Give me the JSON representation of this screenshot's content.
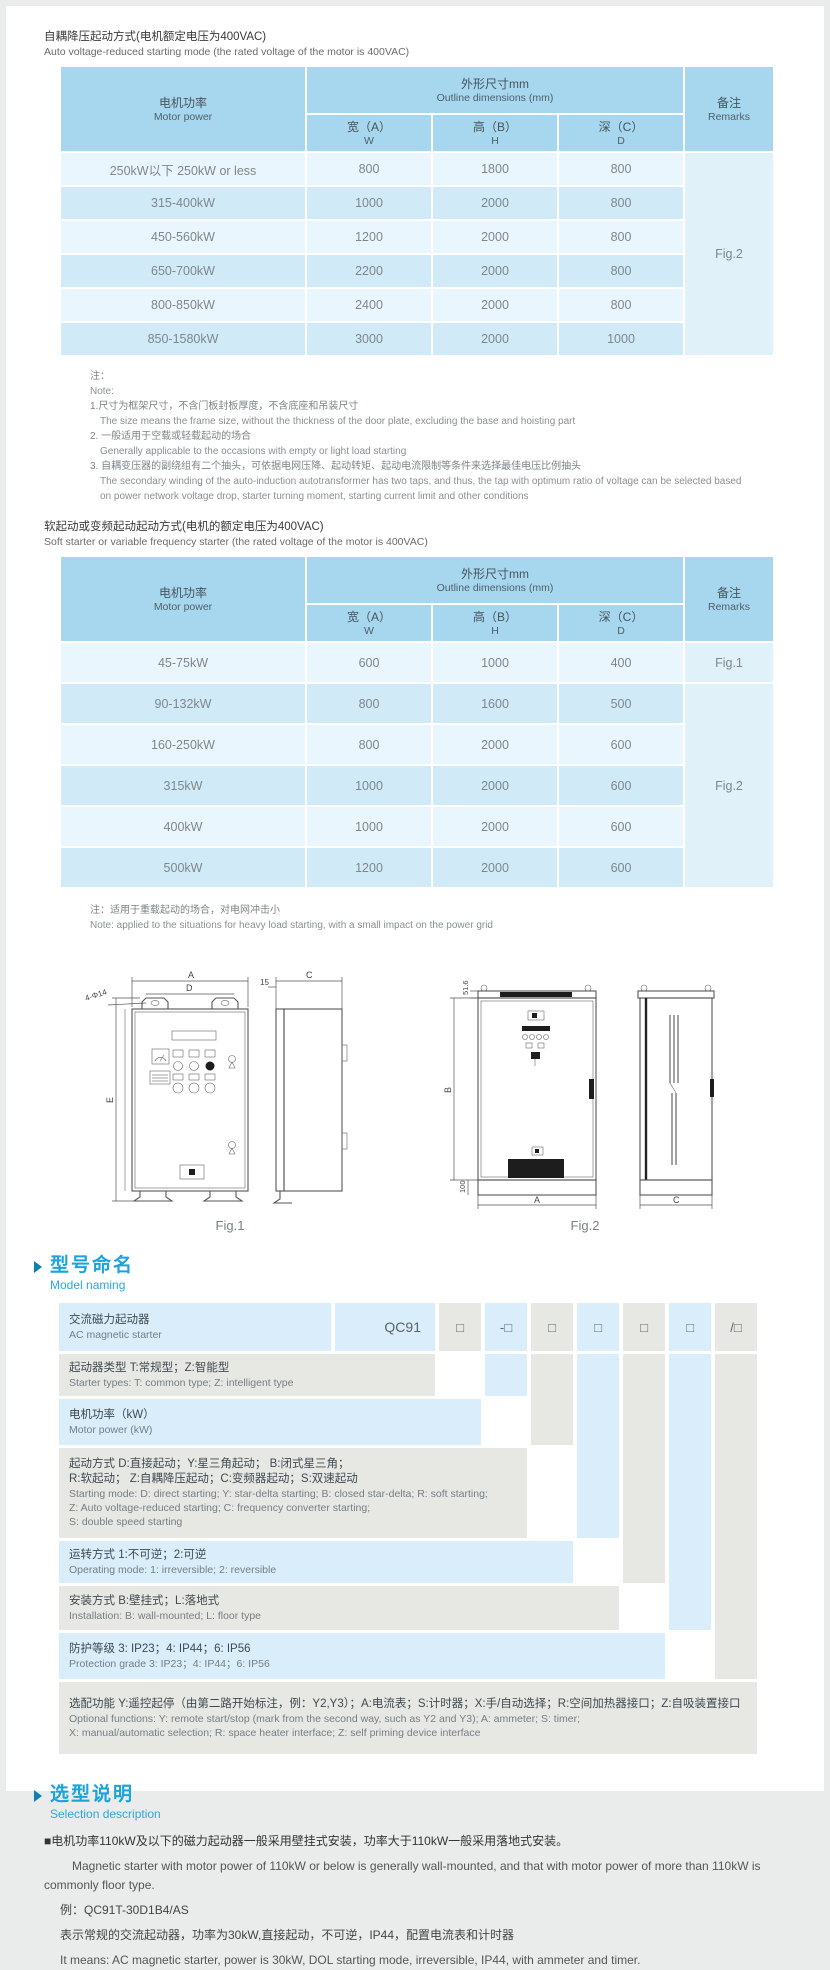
{
  "table1": {
    "title_zh": "自耦降压起动方式(电机额定电压为400VAC)",
    "title_en": "Auto voltage-reduced starting mode (the rated voltage of the motor is 400VAC)",
    "col_motor_zh": "电机功率",
    "col_motor_en": "Motor power",
    "col_dims_zh": "外形尺寸mm",
    "col_dims_en": "Outline dimensions (mm)",
    "col_w_zh": "宽（A）",
    "col_w_en": "W",
    "col_h_zh": "高（B）",
    "col_h_en": "H",
    "col_d_zh": "深（C）",
    "col_d_en": "D",
    "col_rem_zh": "备注",
    "col_rem_en": "Remarks",
    "remark": "Fig.2",
    "rows": [
      {
        "power": "250kW以下 250kW or less",
        "w": "800",
        "h": "1800",
        "d": "800"
      },
      {
        "power": "315-400kW",
        "w": "1000",
        "h": "2000",
        "d": "800"
      },
      {
        "power": "450-560kW",
        "w": "1200",
        "h": "2000",
        "d": "800"
      },
      {
        "power": "650-700kW",
        "w": "2200",
        "h": "2000",
        "d": "800"
      },
      {
        "power": "800-850kW",
        "w": "2400",
        "h": "2000",
        "d": "800"
      },
      {
        "power": "850-1580kW",
        "w": "3000",
        "h": "2000",
        "d": "1000"
      }
    ]
  },
  "notes1": {
    "zh_label": "注：",
    "en_label": "Note:",
    "items": [
      {
        "zh": "1.尺寸为框架尺寸，不含门板封板厚度，不含底座和吊装尺寸",
        "en": "The size means the frame size, without the thickness of the door plate, excluding the base and hoisting part"
      },
      {
        "zh": "2. 一般适用于空载或轻载起动的场合",
        "en": "Generally applicable to the occasions with empty or light load starting"
      },
      {
        "zh": "3. 自耦变压器的副绕组有二个抽头，可依据电网压降、起动转矩、起动电流限制等条件来选择最佳电压比例抽头",
        "en": "The secondary winding of the auto-induction autotransformer has two taps, and thus, the tap with optimum ratio of voltage can be selected based on power network voltage drop, starter turning moment, starting current limit and other conditions"
      }
    ]
  },
  "table2": {
    "title_zh": "软起动或变频起动起动方式(电机的额定电压为400VAC)",
    "title_en": "Soft starter or variable frequency starter (the rated voltage of the motor is 400VAC)",
    "col_motor_zh": "电机功率",
    "col_motor_en": "Motor power",
    "col_dims_zh": "外形尺寸mm",
    "col_dims_en": "Outline dimensions (mm)",
    "col_w_zh": "宽（A）",
    "col_w_en": "W",
    "col_h_zh": "高（B）",
    "col_h_en": "H",
    "col_d_zh": "深（C）",
    "col_d_en": "D",
    "col_rem_zh": "备注",
    "col_rem_en": "Remarks",
    "remark_row1": "Fig.1",
    "remark_rest": "Fig.2",
    "rows": [
      {
        "power": "45-75kW",
        "w": "600",
        "h": "1000",
        "d": "400"
      },
      {
        "power": "90-132kW",
        "w": "800",
        "h": "1600",
        "d": "500"
      },
      {
        "power": "160-250kW",
        "w": "800",
        "h": "2000",
        "d": "600"
      },
      {
        "power": "315kW",
        "w": "1000",
        "h": "2000",
        "d": "600"
      },
      {
        "power": "400kW",
        "w": "1000",
        "h": "2000",
        "d": "600"
      },
      {
        "power": "500kW",
        "w": "1200",
        "h": "2000",
        "d": "600"
      }
    ],
    "note_zh": "注：适用于重载起动的场合，对电网冲击小",
    "note_en": "Note: applied to the situations for heavy load starting, with a small impact on the power grid"
  },
  "figures": {
    "fig1": {
      "caption": "Fig.1",
      "dim_a": "A",
      "dim_d": "D",
      "dim_hole": "4-Φ14",
      "dim_e": "E",
      "dim_15": "15",
      "dim_c": "C"
    },
    "fig2": {
      "caption": "Fig.2",
      "dim_516": "51.6",
      "dim_b": "B",
      "dim_100": "100",
      "dim_a": "A",
      "dim_c": "C"
    }
  },
  "model_naming": {
    "heading_zh": "型号命名",
    "heading_en": "Model naming",
    "row1_zh": "交流磁力起动器",
    "row1_en": "AC magnetic starter",
    "code_prefix": "QC91",
    "boxes": [
      "□",
      "-□",
      "□",
      "□",
      "□",
      "□",
      "/□"
    ],
    "rows": [
      {
        "zh": "起动器类型 T:常规型；Z:智能型",
        "en": "Starter types: T: common type; Z: intelligent type"
      },
      {
        "zh": "电机功率（kW）",
        "en": "Motor power (kW)"
      },
      {
        "zh": "起动方式 D:直接起动；Y:星三角起动；  B:闭式星三角；\n                R:软起动；  Z:自耦降压起动；C:变频器起动；S:双速起动",
        "en": "Starting mode: D: direct starting; Y: star-delta starting; B: closed star-delta; R: soft starting;\n            Z: Auto voltage-reduced starting; C: frequency converter starting;\n            S: double speed starting"
      },
      {
        "zh": "运转方式 1:不可逆；2:可逆",
        "en": "Operating mode: 1: irreversible; 2: reversible"
      },
      {
        "zh": "安装方式 B:壁挂式；L:落地式",
        "en": "Installation: B: wall-mounted; L: floor type"
      },
      {
        "zh": "防护等级 3: IP23；4: IP44；6: IP56",
        "en": "Protection grade 3: IP23；4: IP44；6: IP56"
      },
      {
        "zh": "选配功能 Y:遥控起停（由第二路开始标注，例：Y2,Y3）；A:电流表；S:计时器；X:手/自动选择；R:空间加热器接口；Z:自吸装置接口",
        "en": "Optional functions: Y: remote start/stop (mark from the second way, such as Y2 and Y3); A: ammeter; S: timer;\n            X: manual/automatic selection; R: space heater interface; Z: self priming device interface"
      }
    ]
  },
  "selection": {
    "heading_zh": "选型说明",
    "heading_en": "Selection description",
    "p1_zh": "■电机功率110kW及以下的磁力起动器一般采用壁挂式安装，功率大于110kW一般采用落地式安装。",
    "p1_en": "Magnetic starter with motor power of 110kW or below is generally wall-mounted, and that with motor power of more than 110kW is commonly floor type.",
    "example": "例：QC91T-30D1B4/AS",
    "p2_zh": "表示常规的交流起动器，功率为30kW,直接起动，不可逆，IP44，配置电流表和计时器",
    "p2_en": "It means: AC magnetic starter, power is 30kW, DOL starting mode, irreversible, IP44, with ammeter and timer."
  }
}
